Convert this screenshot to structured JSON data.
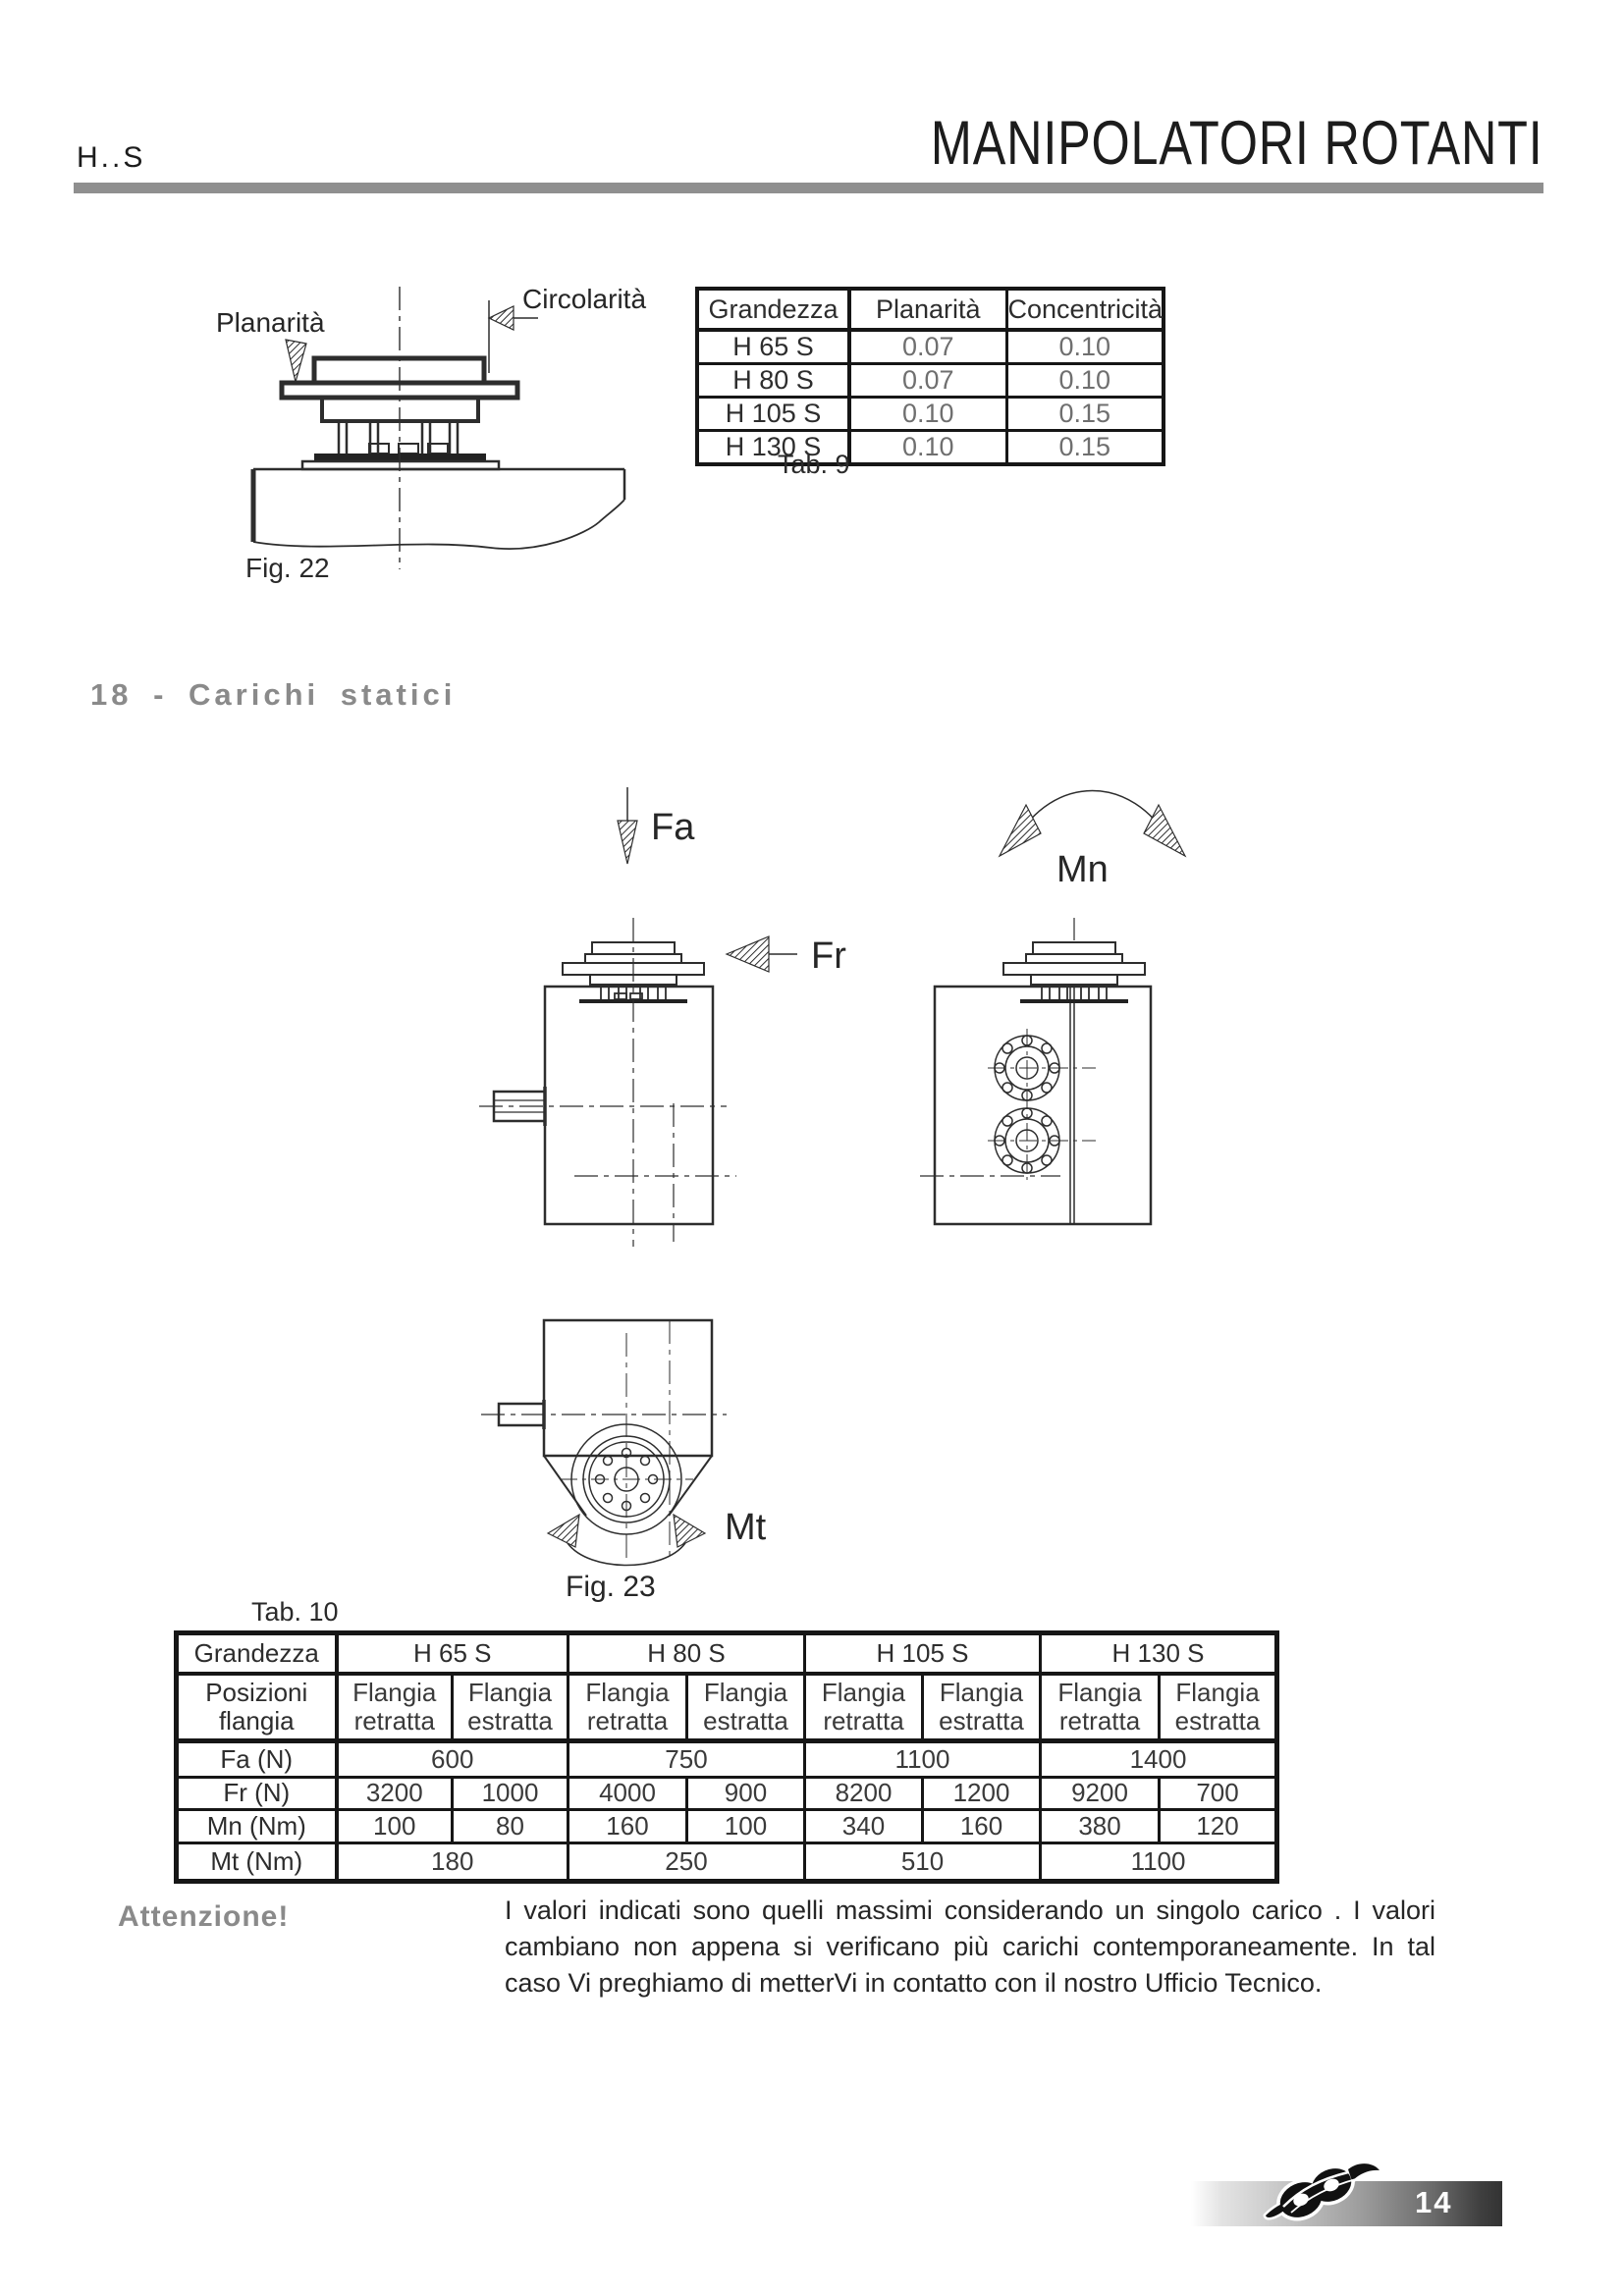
{
  "header": {
    "code": "H..S",
    "title": "MANIPOLATORI ROTANTI"
  },
  "section": {
    "heading": "18 - Carichi statici"
  },
  "fig22": {
    "caption": "Fig. 22",
    "planarita": "Planarità",
    "circolarita": "Circolarità"
  },
  "tab9": {
    "caption": "Tab. 9",
    "headers": [
      "Grandezza",
      "Planarità",
      "Concentricità"
    ],
    "rows": [
      {
        "size": "H 65 S",
        "planarita": "0.07",
        "concentricita": "0.10"
      },
      {
        "size": "H 80 S",
        "planarita": "0.07",
        "concentricita": "0.10"
      },
      {
        "size": "H 105 S",
        "planarita": "0.10",
        "concentricita": "0.15"
      },
      {
        "size": "H 130 S",
        "planarita": "0.10",
        "concentricita": "0.15"
      }
    ]
  },
  "fig23": {
    "caption": "Fig. 23",
    "force_axial": "Fa",
    "moment_n": "Mn",
    "force_radial": "Fr",
    "moment_t": "Mt"
  },
  "tab10": {
    "caption": "Tab. 10",
    "grandezza": "Grandezza",
    "sizes": [
      "H 65 S",
      "H 80 S",
      "H 105 S",
      "H 130 S"
    ],
    "posizioni": "Posizioni flangia",
    "retratta": "Flangia retratta",
    "estratta": "Flangia estratta",
    "rows": {
      "fa": {
        "label": "Fa (N)",
        "values": [
          "600",
          "750",
          "1100",
          "1400"
        ]
      },
      "fr": {
        "label": "Fr (N)",
        "values": [
          "3200",
          "1000",
          "4000",
          "900",
          "8200",
          "1200",
          "9200",
          "700"
        ]
      },
      "mn": {
        "label": "Mn (Nm)",
        "values": [
          "100",
          "80",
          "160",
          "100",
          "340",
          "160",
          "380",
          "120"
        ]
      },
      "mt": {
        "label": "Mt (Nm)",
        "values": [
          "180",
          "250",
          "510",
          "1100"
        ]
      }
    }
  },
  "attention": {
    "label": "Attenzione!",
    "text": "I valori indicati sono quelli massimi considerando un singolo carico . I valori cambiano non appena si verificano più carichi contemporaneamente. In tal caso Vi preghiamo di metterVi in contatto con il nostro Ufficio Tecnico."
  },
  "footer": {
    "page": "14"
  },
  "colors": {
    "accent_gray": "#8a8a8a",
    "rule_gray": "#8f8f8f",
    "line_dark": "#161616"
  }
}
